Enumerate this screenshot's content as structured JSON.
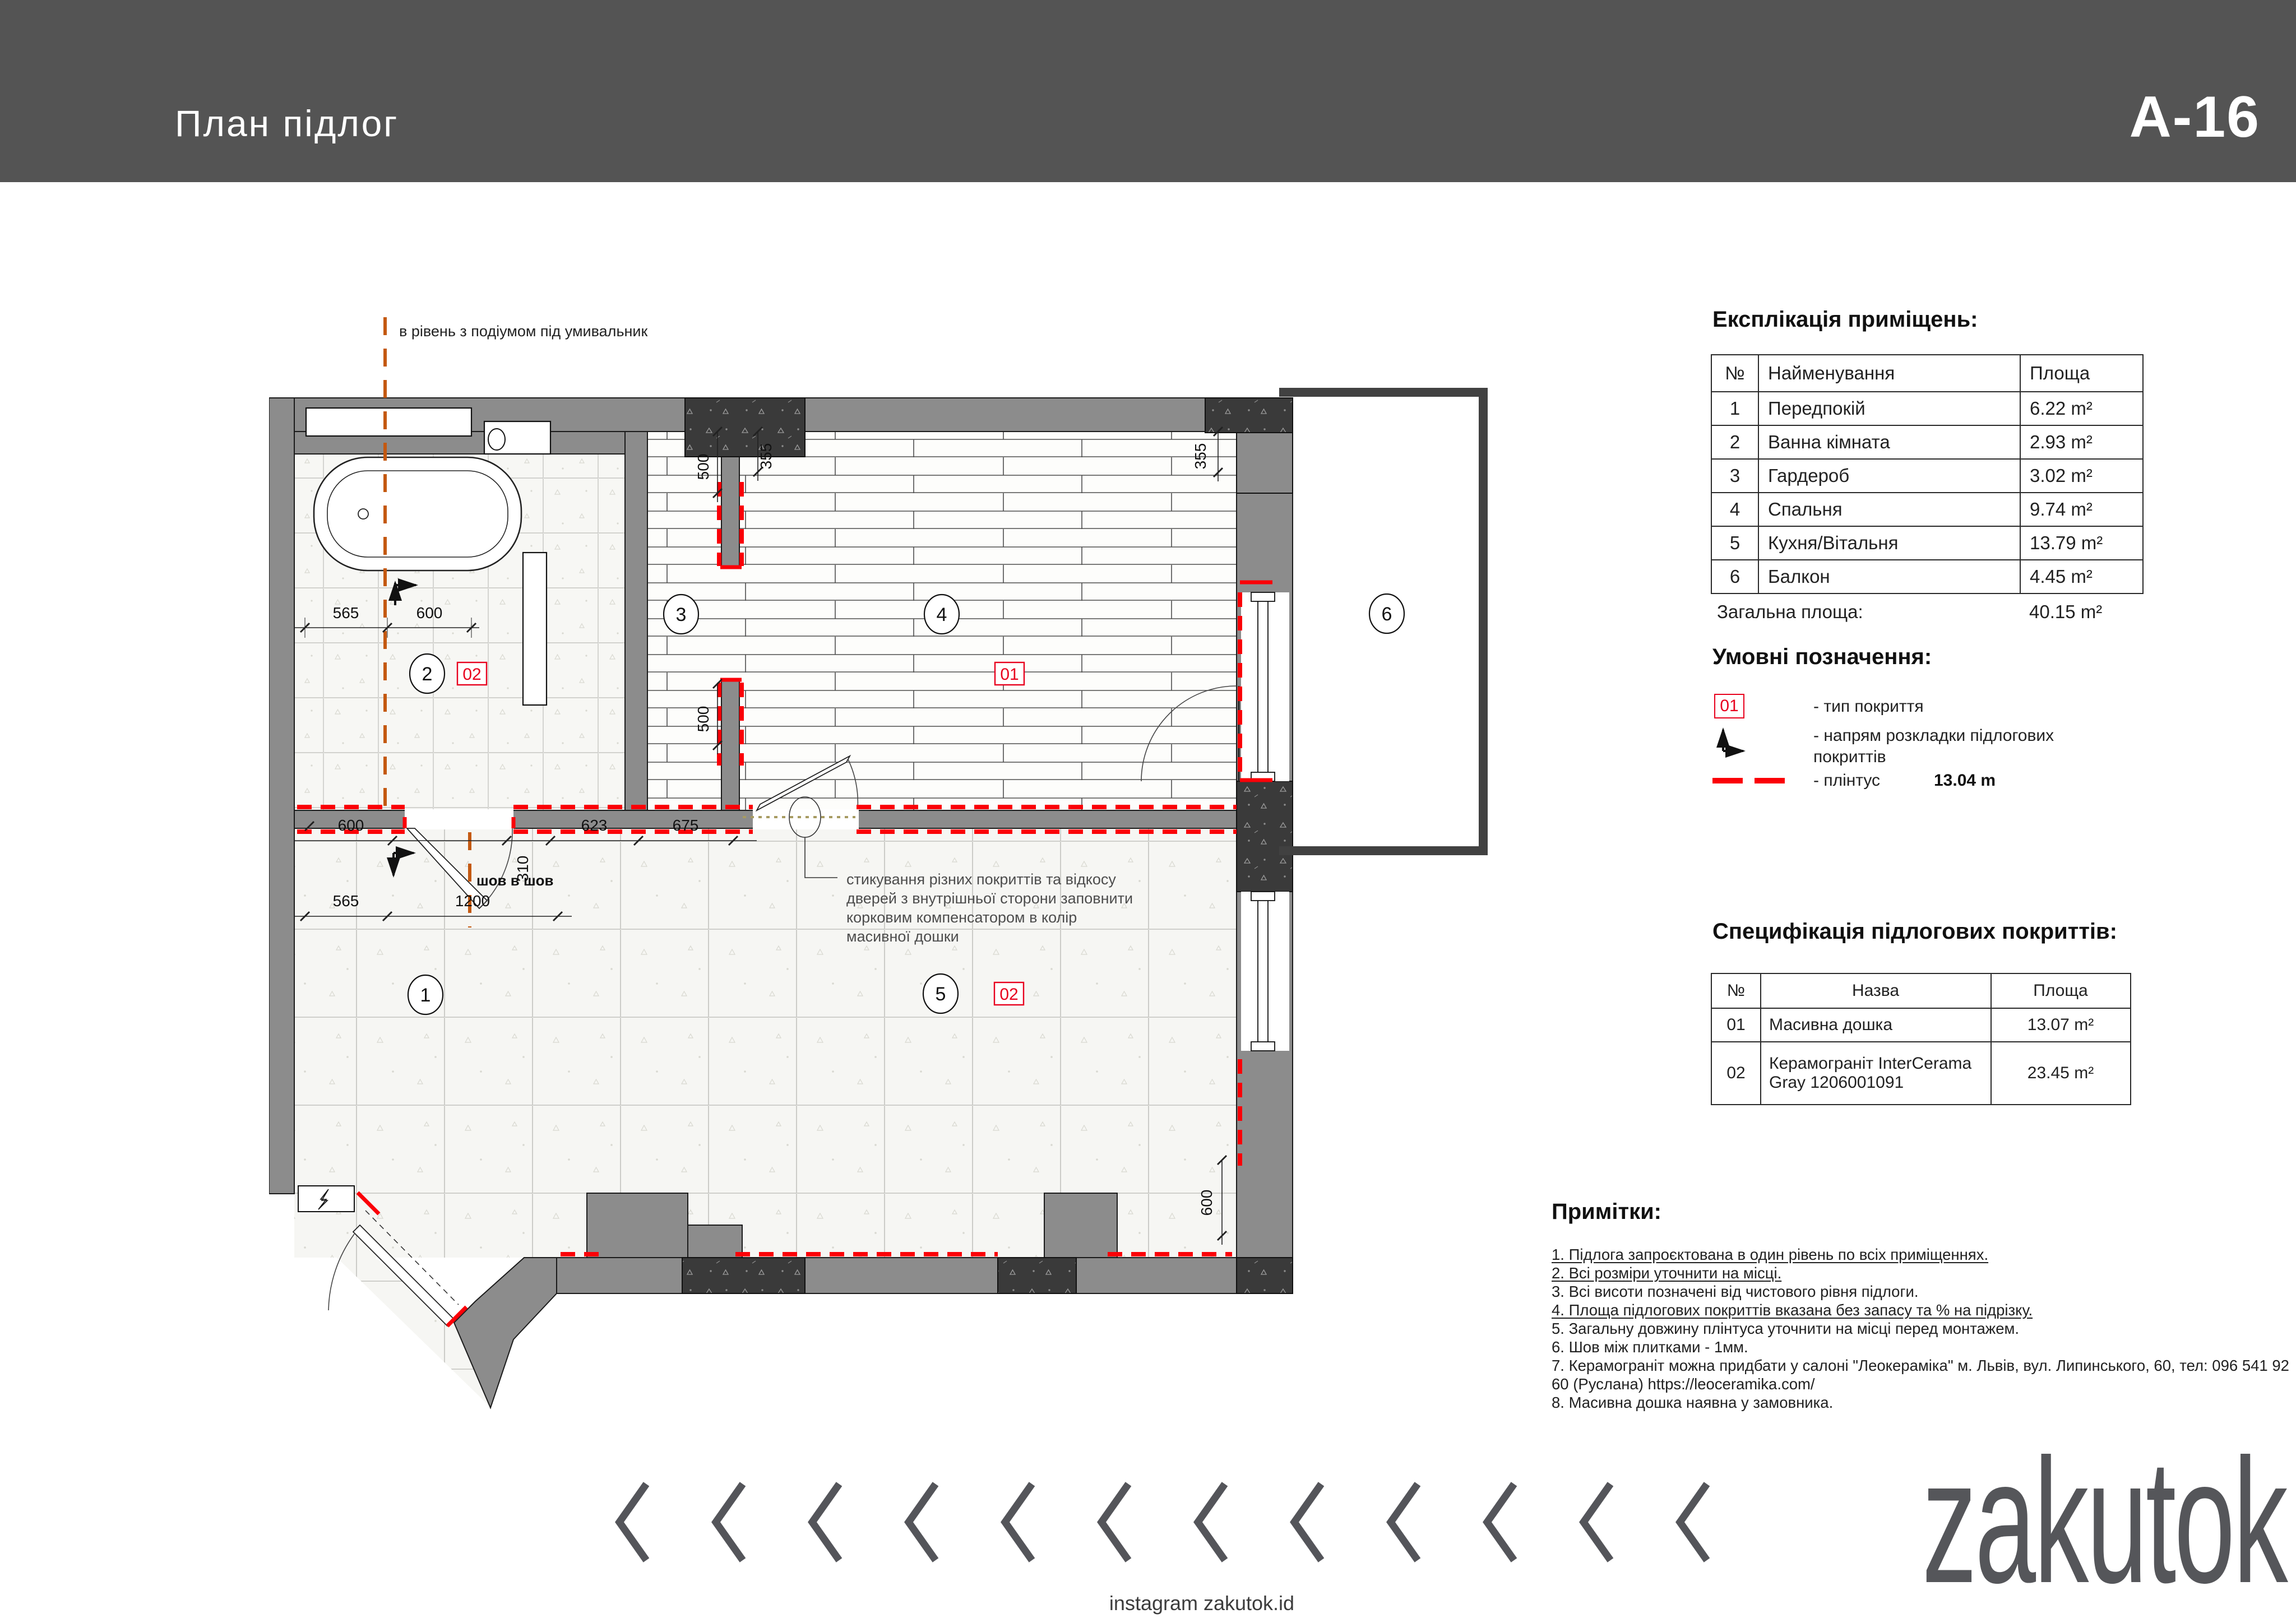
{
  "header": {
    "title": "План підлог",
    "sheet": "A-16"
  },
  "plan": {
    "top_note": "в рівень з подіумом під умивальник",
    "seam_note": "шов в шов",
    "annotation": [
      "стикування різних покриттів та відкосу",
      "дверей з внутрішньої сторони заповнити",
      "корковим компенсатором в колір",
      "масивної дошки"
    ],
    "rooms": [
      "1",
      "2",
      "3",
      "4",
      "5",
      "6"
    ],
    "markers": {
      "m01": "01",
      "m02": "02"
    },
    "dims": {
      "a565": "565",
      "a600": "600",
      "b600": "600",
      "b310": "310",
      "b623": "623",
      "b675": "675",
      "c565": "565",
      "c1200": "1200",
      "v500a": "500",
      "v355a": "355",
      "v500b": "500",
      "v355r": "355",
      "v600r": "600"
    }
  },
  "explication": {
    "title": "Експлікація приміщень:",
    "headers": [
      "№",
      "Найменування",
      "Площа"
    ],
    "rows": [
      [
        "1",
        "Передпокій",
        "6.22 m²"
      ],
      [
        "2",
        "Ванна кімната",
        "2.93 m²"
      ],
      [
        "3",
        "Гардероб",
        "3.02 m²"
      ],
      [
        "4",
        "Спальня",
        "9.74 m²"
      ],
      [
        "5",
        "Кухня/Вітальня",
        "13.79 m²"
      ],
      [
        "6",
        "Балкон",
        "4.45 m²"
      ]
    ],
    "total_label": "Загальна площа:",
    "total_value": "40.15 m²"
  },
  "legend": {
    "title": "Умовні позначення:",
    "item1_badge": "01",
    "item1_label": "- тип покриття",
    "item2_label_1": "- напрям розкладки підлогових",
    "item2_label_2": "покриттів",
    "item3_label": "- плінтус",
    "item3_value": "13.04 m"
  },
  "spec": {
    "title": "Специфікація підлогових покриттів:",
    "headers": [
      "№",
      "Назва",
      "Площа"
    ],
    "rows": [
      [
        "01",
        "Масивна дошка",
        "13.07 m²"
      ],
      [
        "02",
        "Керамограніт InterCerama Gray 1206001091",
        "23.45 m²"
      ]
    ]
  },
  "notes": {
    "title": "Примітки:",
    "items": [
      "1. Підлога запроєктована в один рівень по всіх приміщеннях.",
      "2. Всі розміри уточнити на місці.",
      "3. Всі висоти позначені від чистового рівня підлоги.",
      "4. Площа підлогових покриттів вказана без запасу та % на підрізку.",
      "5. Загальну довжину плінтуса уточнити на місці перед монтажем.",
      "6. Шов між плитками - 1мм.",
      "7. Керамограніт можна придбати у салоні \"Леокераміка\" м. Львів, вул. Липинського, 60, тел: 096 541 92 60 (Руслана) https://leoceramika.com/",
      "8. Масивна дошка наявна у замовника."
    ]
  },
  "footer": {
    "brand": "zakutok",
    "instagram": "instagram zakutok.id"
  },
  "colors": {
    "header_band": "#545454",
    "wall": "#8c8c8c",
    "dark_concrete": "#3a3a3a",
    "plinth_red": "#fb0007",
    "axis_orange": "#c45911",
    "brand_gray": "#55565a"
  }
}
